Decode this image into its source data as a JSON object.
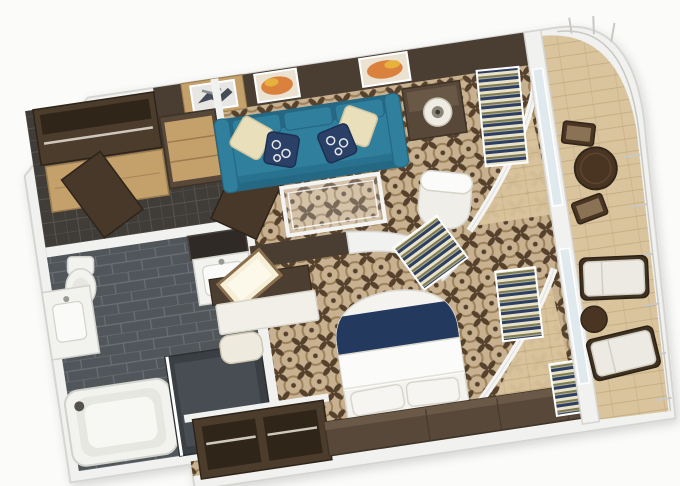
{
  "scene": {
    "type": "3d-floor-plan",
    "subject": "suite-with-balcony",
    "view": "isometric-top-down",
    "rotation_deg": -8.5
  },
  "rooms": [
    {
      "name": "entry-closet",
      "floor": "dark-tile",
      "items": [
        "open-wardrobe-with-rod",
        "sliding-closet-doors",
        "dresser-drawers",
        "entry-door"
      ]
    },
    {
      "name": "bathroom",
      "floor": "dark-gray-tile",
      "items": [
        "bathtub",
        "toilet",
        "left-vanity-sink",
        "right-vanity-sink",
        "mirror",
        "shower-enclosure",
        "bathroom-door"
      ]
    },
    {
      "name": "living-room",
      "floor": "patterned-carpet",
      "items": [
        "teal-sofa",
        "cream-pillow",
        "navy-pattern-pillow",
        "glass-coffee-table",
        "side-table",
        "table-lamp",
        "white-desk-chair",
        "wood-art-panel",
        "orange-wall-art",
        "orange-wall-art",
        "striped-curtains"
      ]
    },
    {
      "name": "bedroom",
      "floor": "patterned-carpet",
      "items": [
        "double-bed",
        "navy-bed-runner",
        "bed-pillows",
        "headboard-cabinet",
        "open-wardrobe-cubbies",
        "vanity-desk",
        "lighted-vanity-panel",
        "stool",
        "curved-partition-wall",
        "striped-curtains"
      ]
    },
    {
      "name": "balcony",
      "floor": "wood-deck",
      "items": [
        "round-dining-table",
        "dining-chair",
        "dining-chair",
        "lounge-chair",
        "lounge-chair",
        "round-side-table",
        "white-railing",
        "glass-sliding-doors",
        "curved-deck-overhang"
      ]
    }
  ],
  "palette": {
    "bg": "#fbfbfa",
    "wall": "#f1f1ef",
    "wall_edge": "#d6d5d1",
    "accent_wall": "#4a3e33",
    "carpet_base": "#c8b191",
    "carpet_motif": "#55412c",
    "carpet_ring": "#9c8159",
    "bath_tile": "#51565a",
    "bath_grout": "#6a7076",
    "entry_tile": "#403c38",
    "entry_grout": "#57534e",
    "deck_wood": "#d9c49d",
    "deck_line": "#c1a87e",
    "glass": "#dfe9ee",
    "sofa": "#2f7f9d",
    "sofa_dark": "#256884",
    "pillow_cream": "#e9dfbb",
    "pillow_cream_edge": "#cfc49e",
    "pillow_navy": "#2a4067",
    "pillow_navy_edge": "#1d3050",
    "wood_light": "#c4a06a",
    "wood_seam": "#9a7b4f",
    "furniture_dark": "#57483a",
    "furniture_darker": "#3e3327",
    "wardrobe_dark": "#4c3c2c",
    "wardrobe_inner": "#2f2519",
    "rod_metal": "#cfc9bd",
    "bed_white": "#f4f3ef",
    "bed_navy": "#24395e",
    "bed_edge": "#dbd9d0",
    "fixture_white": "#f2f2ee",
    "fixture_edge": "#d2d2cc",
    "fixture_inner": "#e7e7e1",
    "curtain_cream": "#eae2c8",
    "curtain_olive": "#7d7b52",
    "curtain_navy": "#2c3e62",
    "table_brown": "#4a3523",
    "table_brown_edge": "#32251a",
    "seat_tan": "#8a7254",
    "art_orange": "#d9772e",
    "art_amber": "#e8b13c",
    "art_dark": "#474d58",
    "art_gray": "#8b8f98",
    "door_dark": "#47382a",
    "door_edge": "#2e2419",
    "shower_dark": "#3a3f44",
    "shower_inner": "#474d52",
    "lamp_base": "#efece3",
    "lamp_inner": "#8a8577",
    "cushion_white": "#eceae2",
    "cushion_edge": "#d2cfc2",
    "railing_line": "#c9c8c3",
    "glow_panel": "#f6efd8",
    "glow_edge": "#8a6f4e",
    "white_frame": "#f4f4f2"
  }
}
